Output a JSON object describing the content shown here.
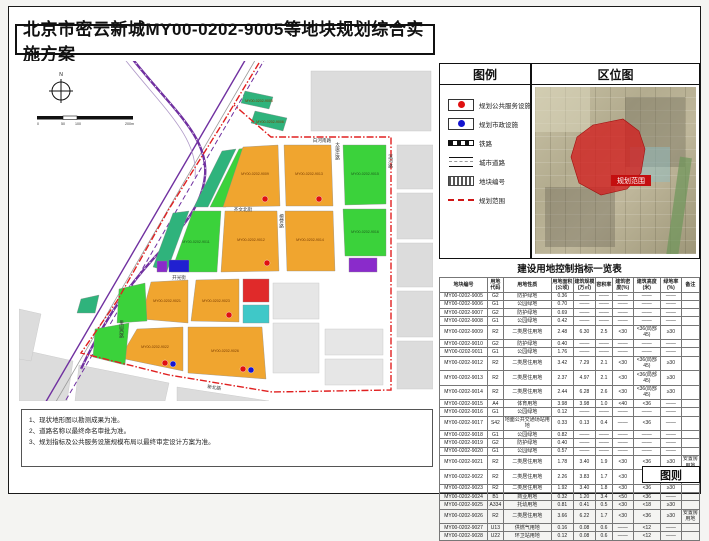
{
  "page": {
    "title": "北京市密云新城MY00-0202-9005等地块规划综合实施方案",
    "corner_label": "图则"
  },
  "legend": {
    "title": "图例",
    "items": [
      {
        "label": "规划公共服务设施",
        "symbol": "red-dot"
      },
      {
        "label": "规划市政设施",
        "symbol": "blue-dot"
      },
      {
        "label": "铁路",
        "symbol": "railway-line"
      },
      {
        "label": "城市道路",
        "symbol": "city-road"
      },
      {
        "label": "地块编号",
        "symbol": "plot-number"
      },
      {
        "label": "规划范围",
        "symbol": "red-dash-boundary"
      }
    ]
  },
  "location": {
    "title": "区位图",
    "range_label": "规划范围"
  },
  "map": {
    "compass_label": "N",
    "scale_ticks": [
      "0",
      "50",
      "100",
      "200m"
    ],
    "plot_labels": {
      "p9005": "MY00-0202-9005",
      "p9006": "MY00-0202-9006",
      "p9009": "MY00-0202-9009",
      "p9011": "MY00-0202-9011",
      "p9012": "MY00-0202-9012",
      "p9013": "MY00-0202-9013",
      "p9014": "MY00-0202-9014",
      "p9015": "MY00-0202-9015",
      "p9016": "MY00-0202-9016",
      "p9021": "MY00-0202-9021",
      "p9022": "MY00-0202-9022",
      "p9023": "MY00-0202-9023",
      "p9026": "MY00-0202-9026"
    },
    "roads": {
      "top": "白河南路",
      "datang": "大唐庄路",
      "tanying": "檀营路",
      "binhe": "滨河路",
      "qiwen": "齐文北街",
      "kaiguang": "开光街",
      "xinbei": "新北路",
      "guoyuan": "果园西路"
    }
  },
  "table": {
    "title": "建设用地控制指标一览表",
    "headers": [
      "地块编号",
      "用地代码",
      "用地性质",
      "用地面积(公顷)",
      "建筑规模(万㎡)",
      "容积率",
      "建筑密度(%)",
      "建筑高度(米)",
      "绿地率(%)",
      "备注"
    ],
    "rows": [
      [
        "MY00-0202-9005",
        "G2",
        "防护绿地",
        "0.36",
        "——",
        "——",
        "——",
        "——",
        "——",
        ""
      ],
      [
        "MY00-0202-9006",
        "G1",
        "公园绿地",
        "0.70",
        "——",
        "——",
        "——",
        "——",
        "——",
        ""
      ],
      [
        "MY00-0202-9007",
        "G2",
        "防护绿地",
        "0.69",
        "——",
        "——",
        "——",
        "——",
        "——",
        ""
      ],
      [
        "MY00-0202-9008",
        "G1",
        "公园绿地",
        "0.42",
        "——",
        "——",
        "——",
        "——",
        "——",
        ""
      ],
      [
        "MY00-0202-9009",
        "R2",
        "二类居住用地",
        "2.48",
        "6.30",
        "2.5",
        "<30",
        "<36(局部45)",
        "≥30",
        ""
      ],
      [
        "MY00-0202-9010",
        "G2",
        "防护绿地",
        "0.40",
        "——",
        "——",
        "——",
        "——",
        "——",
        ""
      ],
      [
        "MY00-0202-9011",
        "G1",
        "公园绿地",
        "1.76",
        "——",
        "——",
        "——",
        "——",
        "——",
        ""
      ],
      [
        "MY00-0202-9012",
        "R2",
        "二类居住用地",
        "3.42",
        "7.29",
        "2.1",
        "<30",
        "<36(局部45)",
        "≥30",
        ""
      ],
      [
        "MY00-0202-9013",
        "R2",
        "二类居住用地",
        "2.37",
        "4.97",
        "2.1",
        "<30",
        "<36(局部45)",
        "≥30",
        ""
      ],
      [
        "MY00-0202-9014",
        "R2",
        "二类居住用地",
        "2.44",
        "6.28",
        "2.6",
        "<30",
        "<36(局部45)",
        "≥30",
        ""
      ],
      [
        "MY00-0202-9015",
        "A4",
        "体育用地",
        "3.98",
        "3.98",
        "1.0",
        "<40",
        "<36",
        "——",
        ""
      ],
      [
        "MY00-0202-9016",
        "G1",
        "公园绿地",
        "0.12",
        "——",
        "——",
        "——",
        "——",
        "——",
        ""
      ],
      [
        "MY00-0202-9017",
        "S42",
        "地面公共交通场站用地",
        "0.33",
        "0.13",
        "0.4",
        "——",
        "<36",
        "——",
        ""
      ],
      [
        "MY00-0202-9018",
        "G1",
        "公园绿地",
        "0.82",
        "——",
        "——",
        "——",
        "——",
        "——",
        ""
      ],
      [
        "MY00-0202-9019",
        "G2",
        "防护绿地",
        "0.40",
        "——",
        "——",
        "——",
        "——",
        "——",
        ""
      ],
      [
        "MY00-0202-9020",
        "G1",
        "公园绿地",
        "0.57",
        "——",
        "——",
        "——",
        "——",
        "——",
        ""
      ],
      [
        "MY00-0202-9021",
        "R2",
        "二类居住用地",
        "1.78",
        "3.40",
        "1.9",
        "<30",
        "<36",
        "≥30",
        "安置房用地"
      ],
      [
        "MY00-0202-9022",
        "R2",
        "二类居住用地",
        "2.26",
        "3.83",
        "1.7",
        "<30",
        "<36",
        "≥30",
        "安置房用地"
      ],
      [
        "MY00-0202-9023",
        "R2",
        "二类居住用地",
        "1.92",
        "3.40",
        "1.8",
        "<30",
        "<36",
        "≥30",
        ""
      ],
      [
        "MY00-0202-9024",
        "B1",
        "商业用地",
        "0.32",
        "1.20",
        "3.4",
        "<50",
        "<36",
        "——",
        ""
      ],
      [
        "MY00-0202-9025",
        "A334",
        "托幼用地",
        "0.81",
        "0.41",
        "0.5",
        "<30",
        "<18",
        "≥30",
        ""
      ],
      [
        "MY00-0202-9026",
        "R2",
        "二类居住用地",
        "3.66",
        "6.22",
        "1.7",
        "<30",
        "<36",
        "≥30",
        "安置房用地"
      ],
      [
        "MY00-0202-9027",
        "U13",
        "供燃气用地",
        "0.16",
        "0.08",
        "0.6",
        "——",
        "<12",
        "——",
        ""
      ],
      [
        "MY00-0202-9028",
        "U22",
        "环卫站用地",
        "0.12",
        "0.08",
        "0.6",
        "——",
        "<12",
        "——",
        ""
      ]
    ]
  },
  "notes": [
    "1、现状地形图以勘测成果为准。",
    "2、道路名称以最终命名审批为准。",
    "3、规划指标及公共服务设施规模布局以最终审定设计方案为准。"
  ],
  "colors": {
    "residential_orange": "#F0A52F",
    "park_green": "#3BD23B",
    "protective_green": "#2FB37C",
    "commercial_red": "#E02A2A",
    "utility_blue": "#2020D0",
    "transport_purple": "#8A2BCB",
    "kindergarten_cyan": "#3FC8C8",
    "boundary_red": "#E02020",
    "railway_purple": "#7030A0"
  }
}
